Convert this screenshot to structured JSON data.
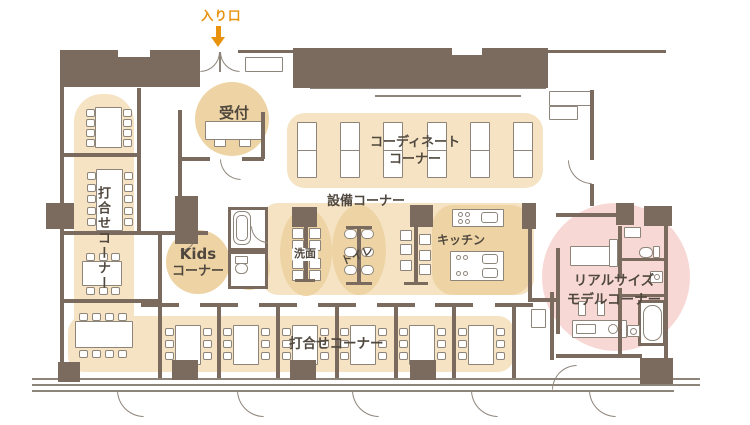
{
  "labels": {
    "entrance": "入り口",
    "reception": "受付",
    "coordinate_line1": "コーディネート",
    "coordinate_line2": "コーナー",
    "equipment": "設備コーナー",
    "meeting_left_vertical": "打合せコーナー",
    "kids_line1": "Kids",
    "kids_line2": "コーナー",
    "washroom": "洗面",
    "toilet": "トイレ",
    "kitchen": "キッチン",
    "model_line1": "リアルサイズ",
    "model_line2": "モデルコーナー",
    "meeting_bottom": "打合せコーナー"
  },
  "colors": {
    "wall": "#7b6b5f",
    "furniture_line": "#8e857a",
    "highlight_light": "#f5e3c3",
    "highlight_accent": "#eed4a4",
    "model_pink": "#f7d8d5",
    "entrance_orange": "#e8920e",
    "label_text": "#50483e"
  }
}
